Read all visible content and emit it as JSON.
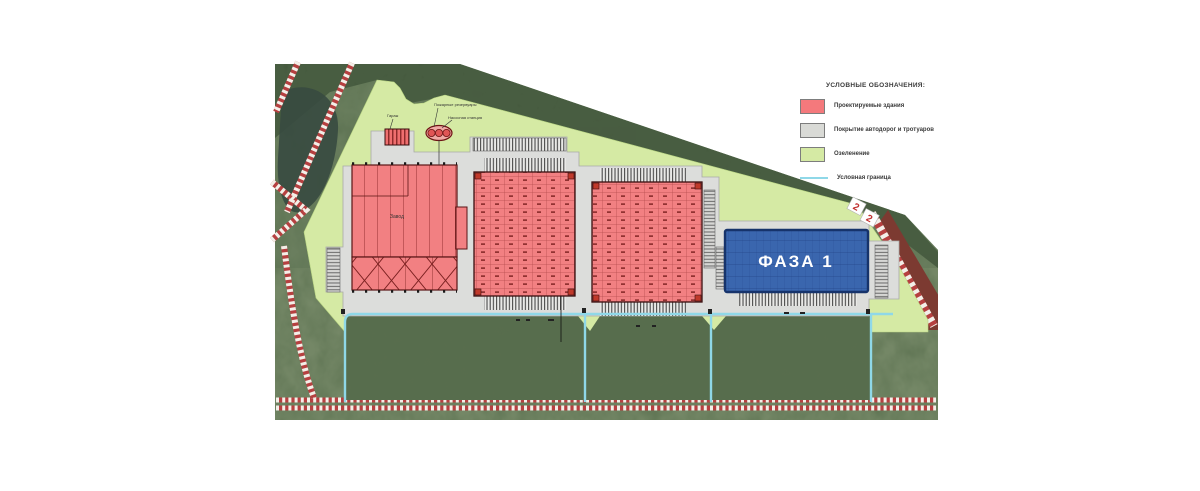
{
  "legend": {
    "title": "УСЛОВНЫЕ ОБОЗНАЧЕНИЯ:",
    "items": [
      {
        "label": "Проектируемые здания",
        "swatch": "#f4797c",
        "kind": "swatch"
      },
      {
        "label": "Покрытие автодорог и тротуаров",
        "swatch": "#d9dad6",
        "kind": "swatch"
      },
      {
        "label": "Озеленение",
        "swatch": "#d5eaa4",
        "kind": "swatch"
      },
      {
        "label": "Условная граница",
        "swatch": "#8fd8e8",
        "kind": "line"
      }
    ]
  },
  "plan": {
    "phase_label": "ФАЗА 1",
    "building1_label": "Завод",
    "garage_label": "Гараж",
    "fire_tanks_label": "Пожарные резервуары",
    "pump_label": "Насосная станция",
    "road_marker_digit": "2",
    "colors": {
      "building_fill": "#f28082",
      "building_line": "#8a2727",
      "pavement": "#dcdddb",
      "greenery": "#d5eaa4",
      "boundary_line": "#8fd8e8",
      "phase_fill": "#3a66ae",
      "phase_border": "#16336b",
      "road_stripe_red": "#b64040",
      "grass": "#5a6f4e",
      "forest": "#3c4f36"
    }
  }
}
